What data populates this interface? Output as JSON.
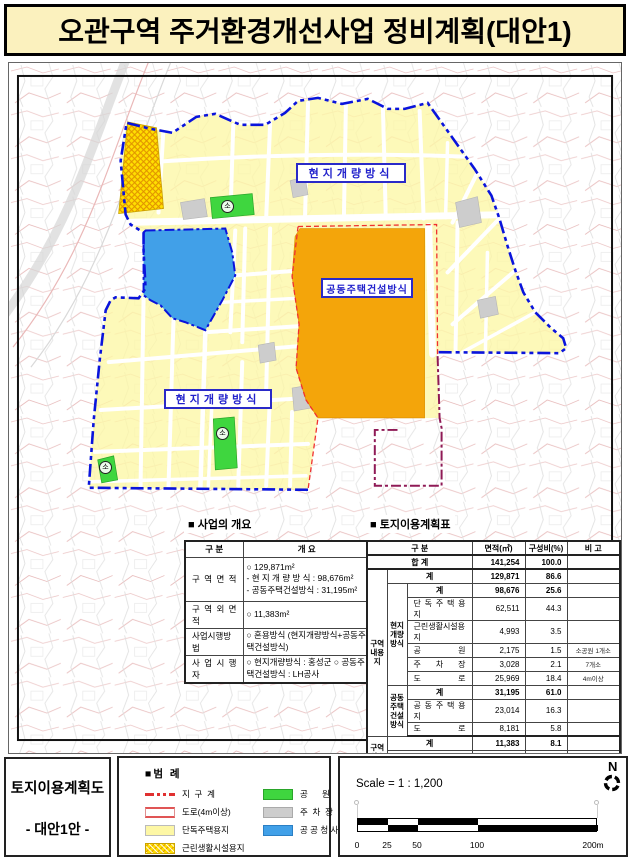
{
  "title": "오관구역 주거환경개선사업 정비계획(대안1)",
  "map": {
    "label_top": "현지개량방식",
    "label_center": "공동주택건설방식",
    "label_bottom": "현지개량방식",
    "park_marker": "소"
  },
  "overview": {
    "heading": "■ 사업의 개요",
    "h_cat": "구  분",
    "h_desc": "개  요",
    "rows": [
      {
        "label": "구 역 면 적",
        "text": "○ 129,871m²\n- 현 지 개 량 방 식 : 98,676m²\n- 공동주택건설방식 : 31,195m²"
      },
      {
        "label": "구 역 외 면 적",
        "text": "○ 11,383m²"
      },
      {
        "label": "사업시행방법",
        "text": "○ 혼용방식 (현지개량방식+공동주택건설방식)"
      },
      {
        "label": "사 업 시 행 자",
        "text": "○ 현지개량방식 : 홍성군 ○ 공동주택건설방식 : LH공사"
      }
    ]
  },
  "landuse": {
    "heading": "■ 토지이용계획표",
    "h_cat": "구  분",
    "h_area": "면적(㎡)",
    "h_ratio": "구성비(%)",
    "h_remark": "비  고",
    "g_inner": "구역\n내용\n지",
    "g_onsite": "현지\n개량\n방식",
    "g_apt": "공동\n주택\n건설\n방식",
    "g_outer": "구역\n외용\n지",
    "total": {
      "label": "합  계",
      "area": "141,254",
      "ratio": "100.0",
      "remark": ""
    },
    "inner_sum": {
      "label": "계",
      "area": "129,871",
      "ratio": "86.6",
      "remark": ""
    },
    "onsite_sum": {
      "label": "계",
      "area": "98,676",
      "ratio": "25.6",
      "remark": ""
    },
    "onsite_rows": [
      {
        "label": "단 독 주 택 용 지",
        "area": "62,511",
        "ratio": "44.3",
        "remark": ""
      },
      {
        "label": "근린생활시설용지",
        "area": "4,993",
        "ratio": "3.5",
        "remark": ""
      },
      {
        "label": "공  원",
        "area": "2,175",
        "ratio": "1.5",
        "remark": "소공원 1개소"
      },
      {
        "label": "주 차 장",
        "area": "3,028",
        "ratio": "2.1",
        "remark": "7개소"
      },
      {
        "label": "도  로",
        "area": "25,969",
        "ratio": "18.4",
        "remark": "4m이상"
      }
    ],
    "apt_sum": {
      "label": "계",
      "area": "31,195",
      "ratio": "61.0",
      "remark": ""
    },
    "apt_rows": [
      {
        "label": "공 동 주 택 용 지",
        "area": "23,014",
        "ratio": "16.3",
        "remark": ""
      },
      {
        "label": "도  로",
        "area": "8,181",
        "ratio": "5.8",
        "remark": ""
      }
    ],
    "outer_sum": {
      "label": "계",
      "area": "11,383",
      "ratio": "8.1",
      "remark": ""
    },
    "outer_rows": [
      {
        "label": "공공청사",
        "area": "10,703",
        "ratio": "7.6",
        "remark": ""
      },
      {
        "label": "도  로",
        "area": "680",
        "ratio": "0.5",
        "remark": "4m이상"
      }
    ]
  },
  "footer": {
    "map_title_line1": "토지이용계획도",
    "map_title_line2": "- 대안1안 -",
    "legend": {
      "heading": "■범  례",
      "items_left": [
        {
          "name": "지  구  계"
        },
        {
          "name": "도로(4m이상)"
        },
        {
          "name": "단독주택용지"
        },
        {
          "name": "근린생활시설용지"
        }
      ],
      "items_right": [
        {
          "name": "공      원"
        },
        {
          "name": "주  차  장"
        },
        {
          "name": "공 공 청 사"
        }
      ]
    },
    "scale": {
      "label": "Scale = 1 : 1,200",
      "north": "N",
      "ticks": [
        "0",
        "25",
        "50",
        "100",
        "200m"
      ]
    }
  },
  "colors": {
    "banner_bg": "#FBF1BE",
    "single_housing": "#FDF7A5",
    "neighborhood_facility": "#FFDF00",
    "apartment_zone": "#F4A50A",
    "public_office": "#41A0E8",
    "park": "#3FD63F",
    "parking": "#CDCDCD",
    "district_boundary": "#0a14dc",
    "plan_boundary_red": "#f03030",
    "plan_boundary_purple": "#8f1a56"
  }
}
